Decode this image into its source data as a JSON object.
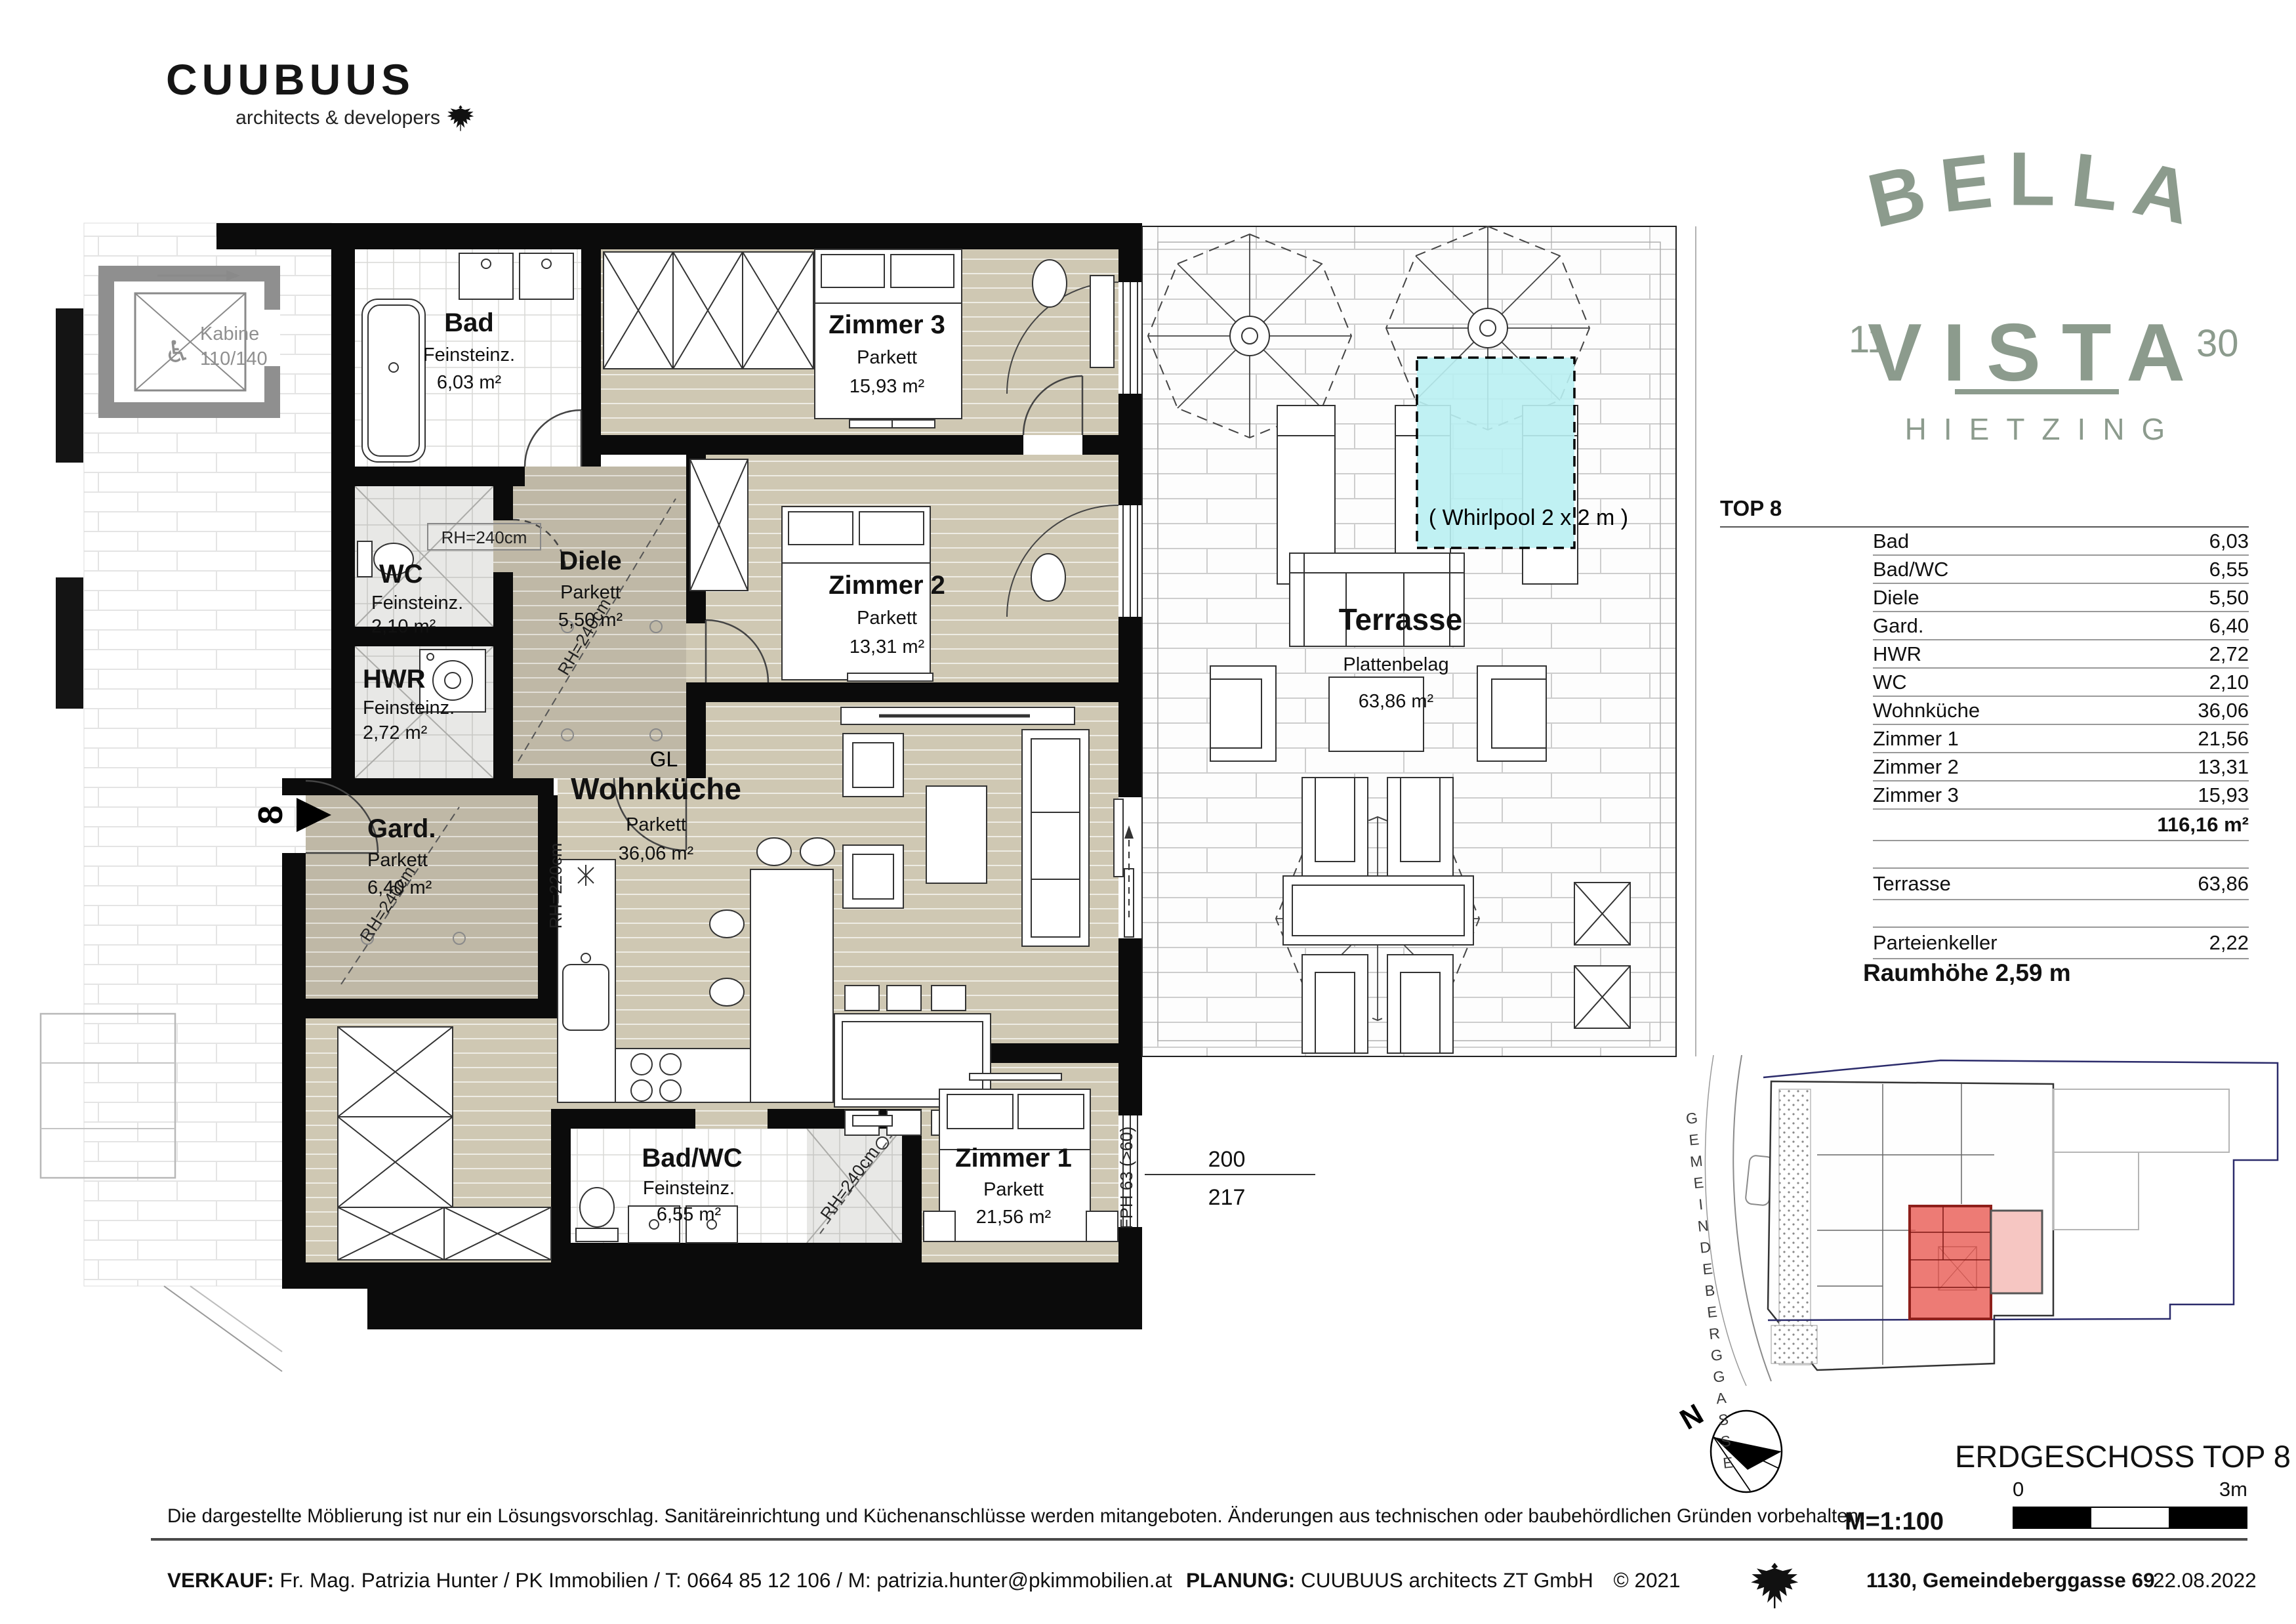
{
  "brand": {
    "name": "CUUBUUS",
    "sub": "architects & developers"
  },
  "logo": {
    "bella": "BELLA",
    "vista": "VISTA",
    "left": "11",
    "right": "30",
    "city": "HIETZING"
  },
  "plan": {
    "rooms": [
      {
        "name": "Bad",
        "floor": "Feinsteinz.",
        "area": "6,03 m²"
      },
      {
        "name": "WC",
        "floor": "Feinsteinz.",
        "area": "2,10 m²"
      },
      {
        "name": "HWR",
        "floor": "Feinsteinz.",
        "area": "2,72 m²"
      },
      {
        "name": "Gard.",
        "floor": "Parkett",
        "area": "6,40 m²"
      },
      {
        "name": "Diele",
        "floor": "Parkett",
        "area": "5,50 m²"
      },
      {
        "name": "Zimmer 3",
        "floor": "Parkett",
        "area": "15,93 m²"
      },
      {
        "name": "Zimmer 2",
        "floor": "Parkett",
        "area": "13,31 m²"
      },
      {
        "name": "Wohnküche",
        "floor": "Parkett",
        "area": "36,06 m²"
      },
      {
        "name": "Bad/WC",
        "floor": "Feinsteinz.",
        "area": "6,55 m²"
      },
      {
        "name": "Zimmer 1",
        "floor": "Parkett",
        "area": "21,56 m²"
      }
    ],
    "terrace": {
      "name": "Terrasse",
      "floor": "Plattenbelag",
      "area": "63,86 m²",
      "whirlpool": "( Whirlpool 2 x 2 m )"
    },
    "annotations": {
      "kabine1": "Kabine",
      "kabine2": "110/140",
      "wheelchair": "♿",
      "rh240": "RH=240cm",
      "rh220": "RH=220cm",
      "deckenkante": "Deckenkante",
      "fph": "FPH 63 (>60)",
      "gl": "GL",
      "unit": "8"
    },
    "dims": [
      {
        "num": "200",
        "den": "243"
      },
      {
        "num": "200",
        "den": "243"
      },
      {
        "num": "360",
        "den": "243"
      },
      {
        "num": "200",
        "den": "217"
      }
    ]
  },
  "table": {
    "title": "TOP 8",
    "rows": [
      {
        "label": "Bad",
        "value": "6,03"
      },
      {
        "label": "Bad/WC",
        "value": "6,55"
      },
      {
        "label": "Diele",
        "value": "5,50"
      },
      {
        "label": "Gard.",
        "value": "6,40"
      },
      {
        "label": "HWR",
        "value": "2,72"
      },
      {
        "label": "WC",
        "value": "2,10"
      },
      {
        "label": "Wohnküche",
        "value": "36,06"
      },
      {
        "label": "Zimmer 1",
        "value": "21,56"
      },
      {
        "label": "Zimmer 2",
        "value": "13,31"
      },
      {
        "label": "Zimmer 3",
        "value": "15,93"
      }
    ],
    "total": "116,16 m²",
    "terrasse": {
      "label": "Terrasse",
      "value": "63,86"
    },
    "keller": {
      "label": "Parteienkeller",
      "value": "2,22"
    }
  },
  "info": {
    "raumhoehe": "Raumhöhe 2,59 m",
    "street": "GEMEINDEBERGGASSE",
    "floor_title": "ERDGESCHOSS TOP 8",
    "scale": "M=1:100",
    "scale_zero": "0",
    "scale_end": "3m",
    "north": "N"
  },
  "footer": {
    "disclaimer": "Die dargestellte Möblierung ist nur ein Lösungsvorschlag. Sanitäreinrichtung und Küchenanschlüsse werden mitangeboten. Änderungen aus technischen oder baubehördlichen Gründen vorbehalten.",
    "verkauf_label": "VERKAUF:",
    "verkauf_text": "Fr. Mag. Patrizia Hunter / PK Immobilien / T: 0664 85 12 106 / M: patrizia.hunter@pkimmobilien.at",
    "planung_label": "PLANUNG:",
    "planung_text": "CUUBUUS architects ZT GmbH",
    "copyright": "©  2021",
    "address": "1130, Gemeindeberggasse 69",
    "date": "22.08.2022"
  },
  "colors": {
    "parkett": "#CFC8B3",
    "parkett_dark": "#BFB8A6",
    "whirlpool": "#B9EFF2",
    "logo_green": "#8C9B8D",
    "unit_red": "#E8564E",
    "terrace_red": "#F6C6C2"
  }
}
